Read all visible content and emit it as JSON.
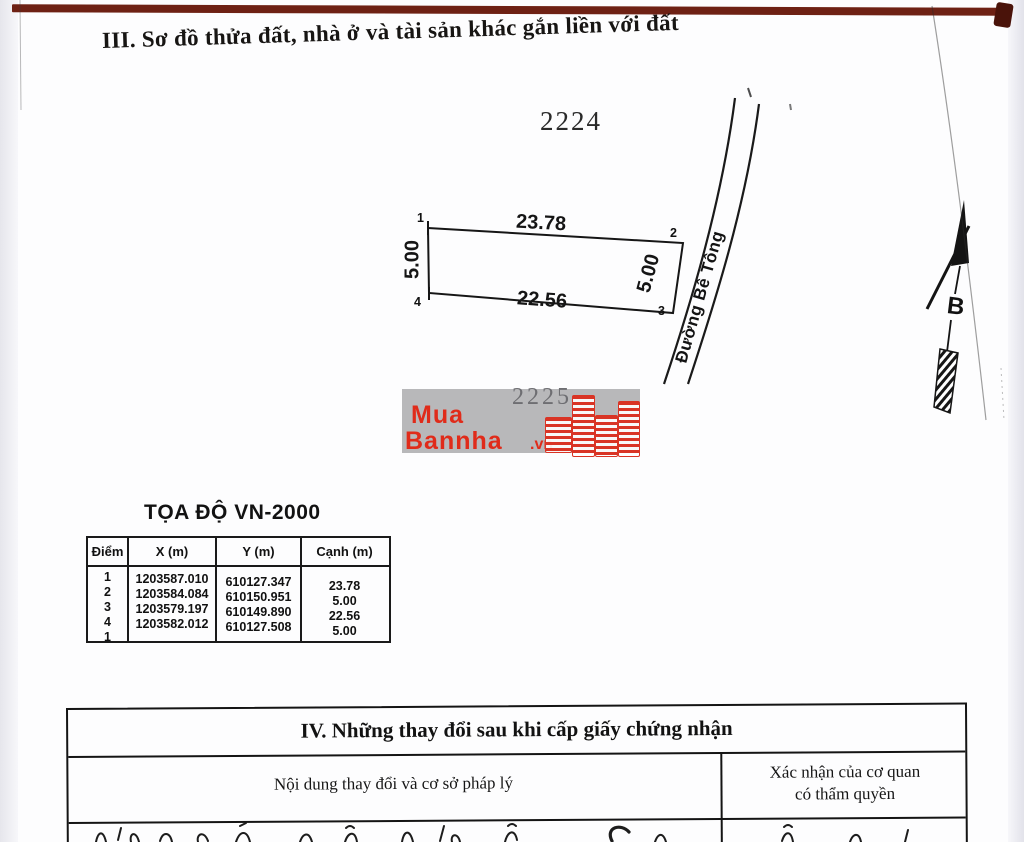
{
  "section3": {
    "title": "III. Sơ đồ thửa đất, nhà ở và tài sản khác gắn liền với đất"
  },
  "parcel": {
    "plot_number_top": "2224",
    "plot_number_bottom": "2225",
    "corners": [
      "1",
      "2",
      "3",
      "4"
    ],
    "edge_top": "23.78",
    "edge_right": "5.00",
    "edge_bottom": "22.56",
    "edge_left": "5.00",
    "road_label": "Đường Bê Tông",
    "north_label": "B"
  },
  "watermark": {
    "line1": "Mua",
    "line2": "Bannha",
    "suffix": ".vn",
    "red": "#e02b1a"
  },
  "coords": {
    "title": "TỌA ĐỘ VN-2000",
    "headers": [
      "Điểm",
      "X (m)",
      "Y (m)",
      "Cạnh (m)"
    ],
    "diem_list": "1\n2\n3\n4\n1",
    "x_list": "1203587.010\n1203584.084\n1203579.197\n1203582.012",
    "y_list": "610127.347\n610150.951\n610149.890\n610127.508",
    "canh_list": "23.78\n5.00\n22.56\n5.00"
  },
  "section4": {
    "title": "IV. Những thay đổi sau khi cấp giấy chứng nhận",
    "col_left": "Nội dung thay đổi và cơ sở pháp lý",
    "col_right_line1": "Xác nhận của cơ quan",
    "col_right_line2": "có thẩm quyền"
  }
}
